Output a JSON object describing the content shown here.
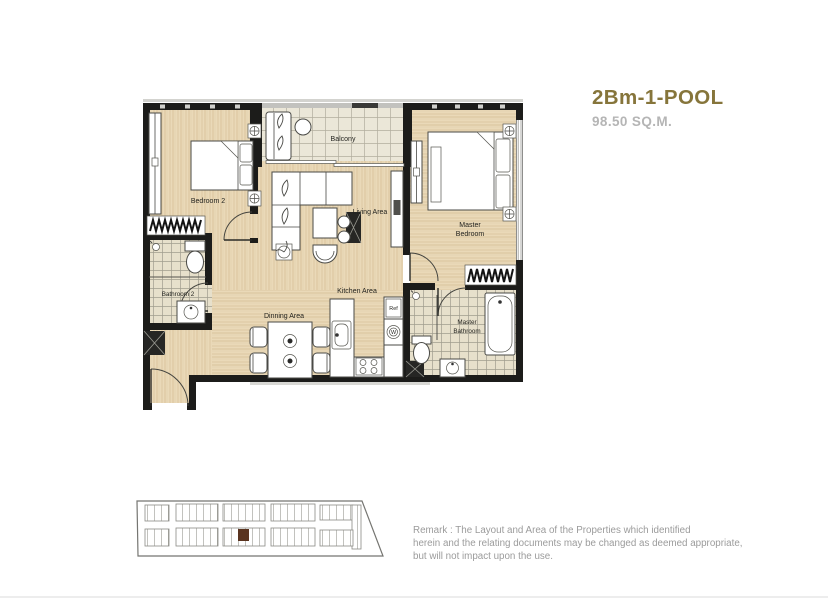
{
  "title_block": {
    "unit_name": "2Bm-1-POOL",
    "unit_area": "98.50 SQ.M.",
    "name_color": "#86753b",
    "area_color": "#b5b5b5"
  },
  "floor_plan": {
    "labels": {
      "bedroom2": "Bedroom 2",
      "balcony": "Balcony",
      "living": "Living Area",
      "master_bedroom_1": "Master",
      "master_bedroom_2": "Bedroom",
      "bathroom2": "Bathroom 2",
      "kitchen": "Kitchen Area",
      "dining": "Dinning Area",
      "master_bathroom_1": "Master",
      "master_bathroom_2": "Bathroom",
      "fridge": "Ref",
      "washer": "W"
    },
    "colors": {
      "wall": "#1c1c1a",
      "wood_floor": "#ead9b8",
      "tile_floor": "#e7e0cb",
      "balcony_floor": "#ebe7d8",
      "furniture_outline": "#4a4a46"
    }
  },
  "key_plan": {
    "outline_color": "#757571",
    "unit_color": "#8a8a84",
    "highlight_color": "#5a3420"
  },
  "remark": {
    "line1": "Remark : The Layout and Area of the Properties which identified",
    "line2": "herein and the relating documents may be changed as deemed appropriate,",
    "line3": "but will not impact upon the use."
  }
}
